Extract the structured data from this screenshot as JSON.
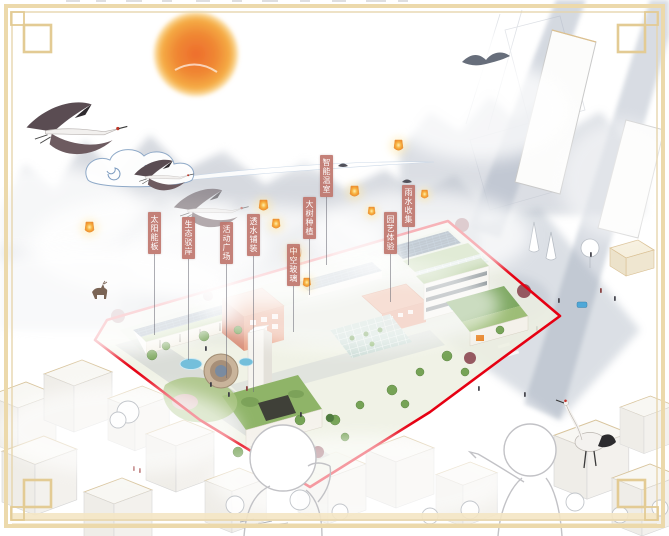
{
  "scene": {
    "kind": "architectural-aerial-rendering",
    "style": "chinese-ink-watercolor-collage"
  },
  "callouts": [
    {
      "label": "太阳能板"
    },
    {
      "label": "生态驳岸"
    },
    {
      "label": "活动广场"
    },
    {
      "label": "透水铺装"
    },
    {
      "label": "中空玻璃"
    },
    {
      "label": "大树种植"
    },
    {
      "label": "智能温室"
    },
    {
      "label": "园艺体验"
    },
    {
      "label": "雨水收集"
    }
  ],
  "colors": {
    "site_outline": "#e60012",
    "frame_gold": "#e6cf9e",
    "callout_bg": "#c0776e",
    "callout_text": "#ffffff",
    "leader_line": "#6a6a74",
    "sun": "#f1882f",
    "solar_panel": "#35536e",
    "green_roof": "#9dbd77",
    "terracotta": "#e8a287",
    "water": "#74bfdb",
    "lantern": "#f6a63a"
  },
  "decorations": {
    "icons": [
      "sun-icon",
      "flying-crane-icon",
      "standing-crane-icon",
      "sky-lantern-icon",
      "spiral-cloud-icon",
      "mountain-mist",
      "deer-icon",
      "corner-frame-ornament"
    ]
  }
}
